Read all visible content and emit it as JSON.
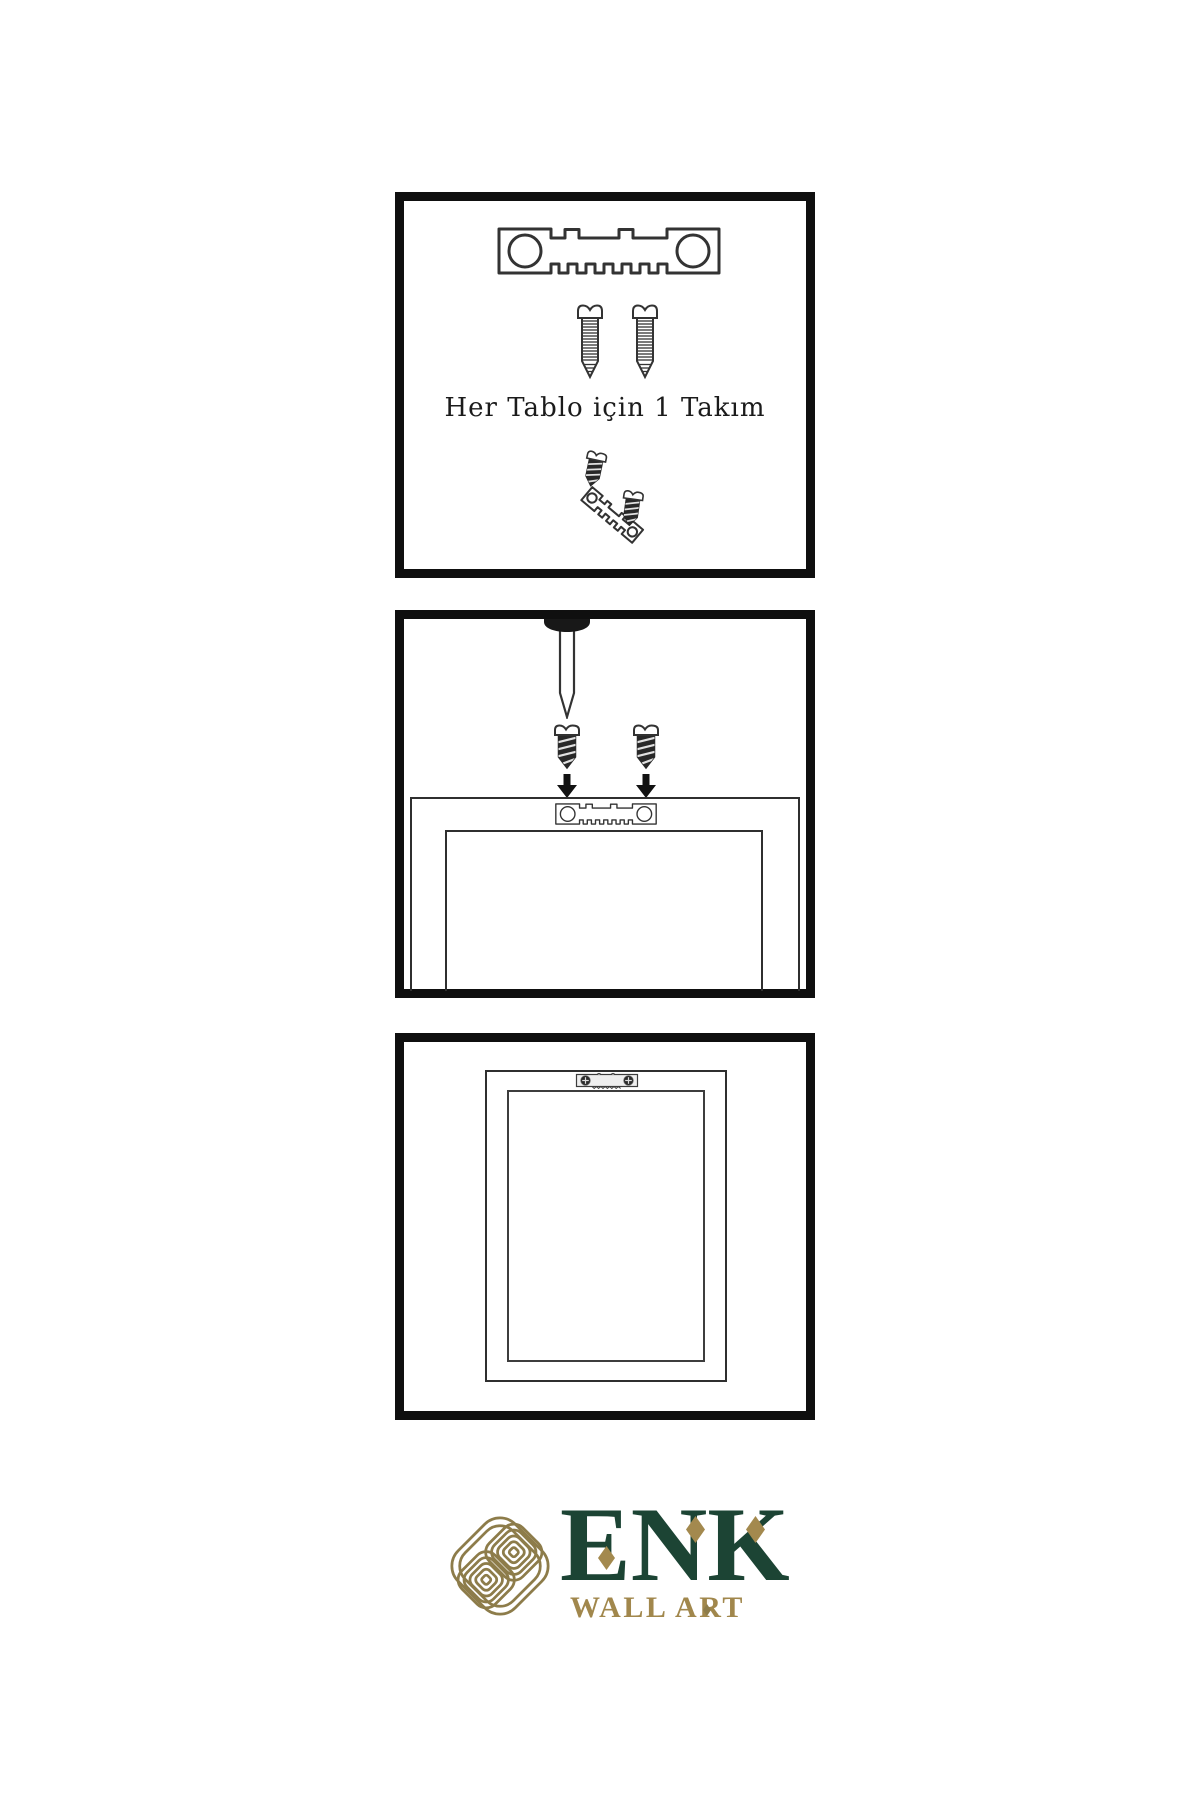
{
  "background": "#ffffff",
  "steps": [
    {
      "name": "hardware-kit",
      "caption": "Her Tablo için 1 Takım",
      "icons": [
        "sawtooth-hanger-icon",
        "screw-icon",
        "screw-icon",
        "tilted-sawtooth-hanger-icon",
        "dark-screw-icon",
        "dark-screw-icon"
      ]
    },
    {
      "name": "attach-hanger-to-frame",
      "icons": [
        "wall-nail-icon",
        "dark-screw-icon",
        "dark-screw-icon",
        "down-arrow-icon",
        "down-arrow-icon",
        "sawtooth-hanger-icon",
        "frame-back-outline"
      ]
    },
    {
      "name": "mounted-frame",
      "icons": [
        "mounted-sawtooth-hanger-icon",
        "frame-back-outline"
      ]
    }
  ],
  "brand": {
    "wordmark": "ENK",
    "subtitle": "WALL ART",
    "icons": [
      "knot-icon",
      "diamond-icon",
      "diamond-icon",
      "diamond-icon",
      "diamond-icon"
    ],
    "colors": {
      "green": "#1c4434",
      "gold": "#a1874c",
      "knot_gold": "#8d7c4a",
      "line_art": "#333333",
      "panel_border": "#0f0f0f"
    }
  }
}
